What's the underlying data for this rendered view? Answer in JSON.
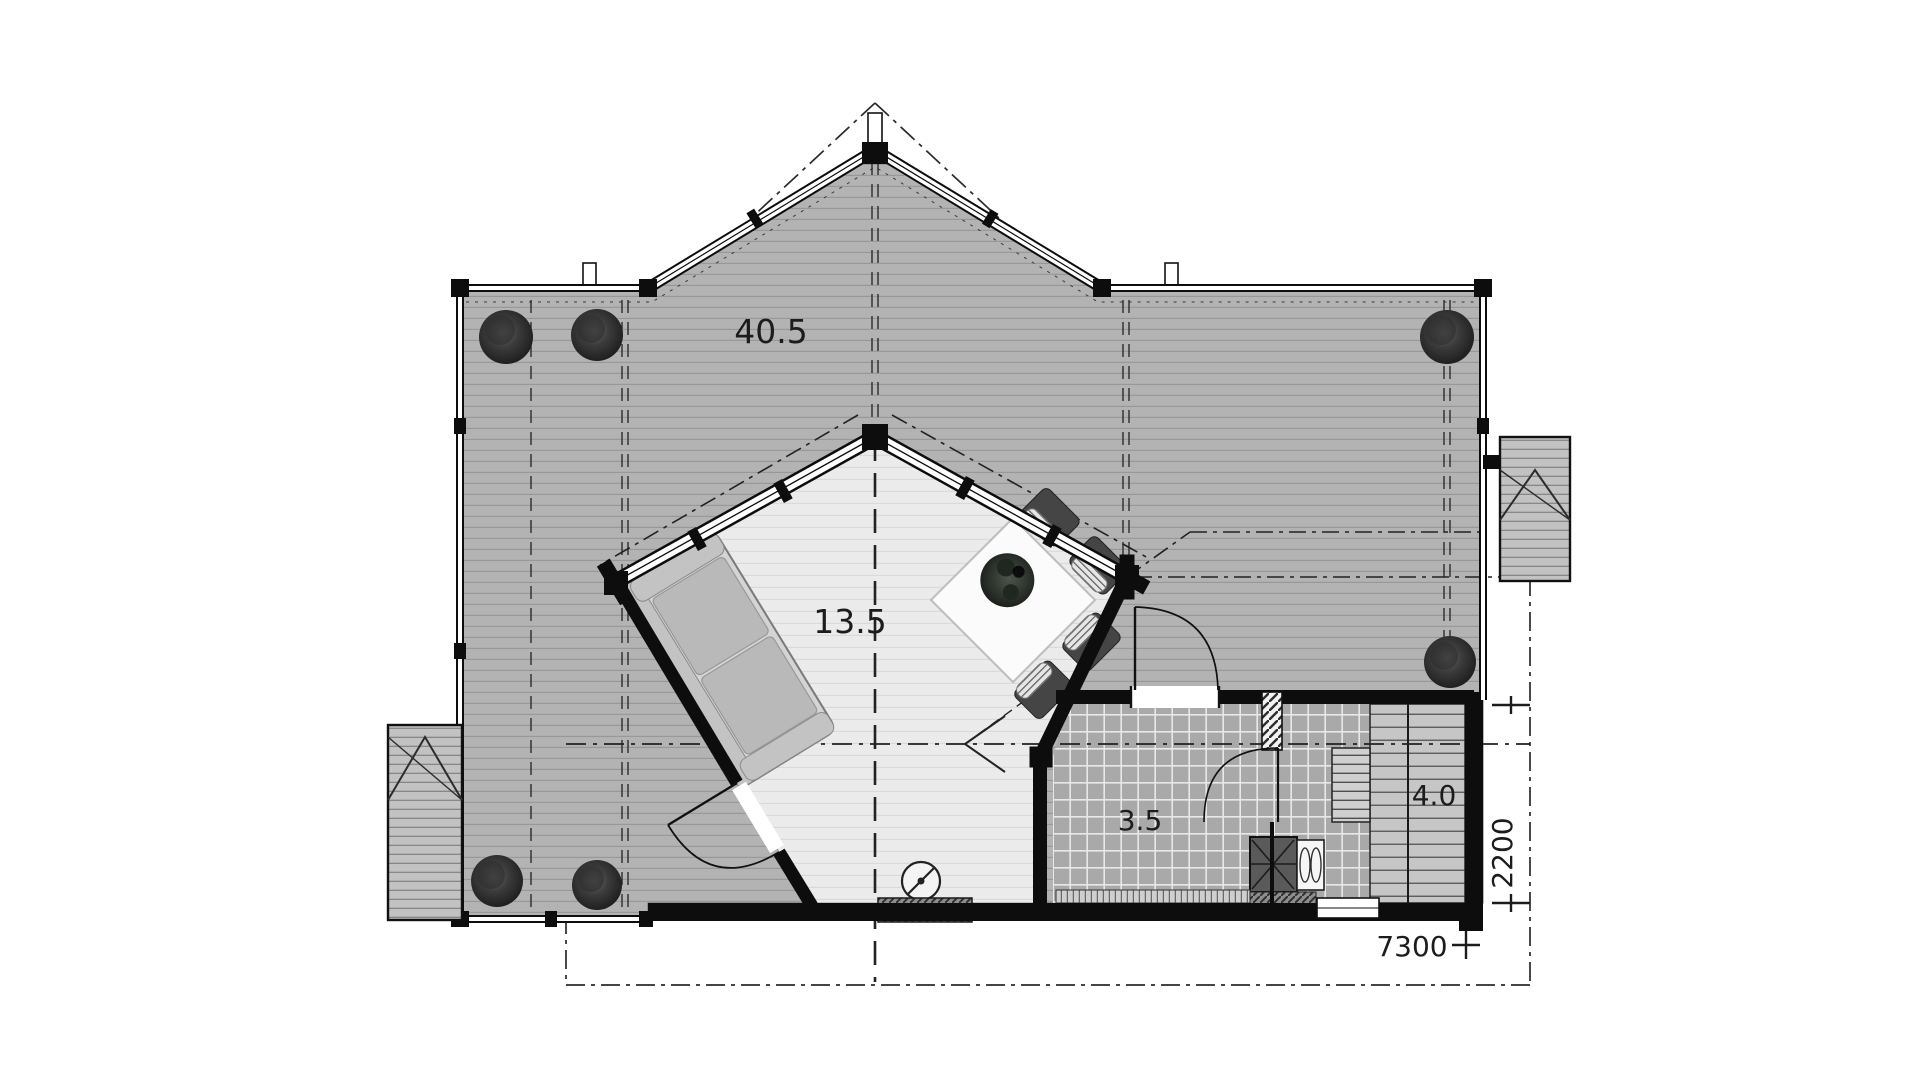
{
  "plan": {
    "type": "architectural-floor-plan",
    "room_areas": [
      {
        "id": "terrace",
        "label": "40.5"
      },
      {
        "id": "living",
        "label": "13.5"
      },
      {
        "id": "shower",
        "label": "3.5"
      },
      {
        "id": "sauna_stairs",
        "label": "4.0"
      }
    ],
    "dimensions": [
      {
        "id": "depth_right",
        "label": "2200",
        "orientation": "vertical"
      },
      {
        "id": "width_bottom",
        "label": "7300",
        "orientation": "horizontal"
      }
    ],
    "symbols": {
      "bush": "shrub plan symbol",
      "sofa": "sofa plan symbol",
      "dining_set": "square table with four chairs and plant",
      "stove": "sauna stove with bench",
      "floor_drain": "circle with diagonal slash",
      "door": "quarter-circle swing arc",
      "roof": "dash-dot roof outline"
    },
    "colors": {
      "paper": "#ffffff",
      "deck": "#b3b3b3",
      "deck_line": "#979797",
      "room": "#ebebeb",
      "room_line": "#dadada",
      "tile": "#a9a9a9",
      "tile_line": "#e8e8e8",
      "tread": "#c6c6c6",
      "tread_line": "#5f5f5f",
      "wall": "#0d0d0d",
      "text": "#1c1c1c"
    }
  }
}
